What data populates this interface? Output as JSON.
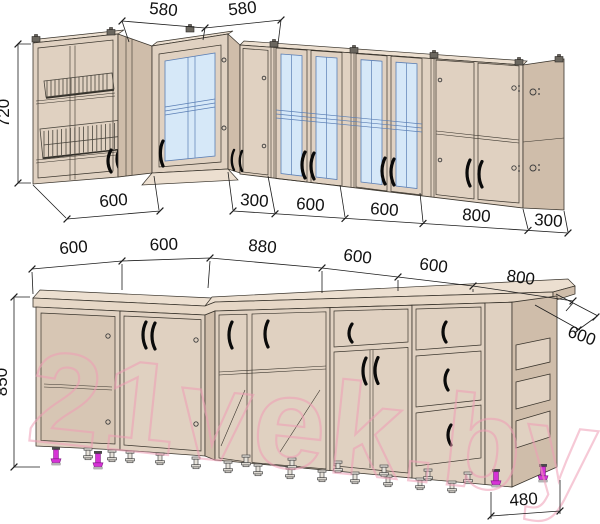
{
  "colors": {
    "face": "#e0d1c1",
    "side": "#cfbdaa",
    "ctop": "#ecdfd0",
    "counter": "#e6d7c6",
    "interior": "#d7c6b4",
    "glass": "#d6e8f8",
    "glassline": "#5b7fb5",
    "outline": "#3a352d",
    "dim": "#1c1c1c",
    "wm": "#ef9db5",
    "magenta": "#d633d6"
  },
  "watermark": {
    "text": "21vek.by"
  },
  "upper": {
    "height": "720",
    "top": [
      "580",
      "580"
    ],
    "bottom": [
      "600",
      "300",
      "600",
      "600",
      "800",
      "300"
    ]
  },
  "lower": {
    "height": "850",
    "top": [
      "600",
      "600",
      "880",
      "600",
      "600",
      "800"
    ],
    "depth": "600",
    "bottom": "480"
  }
}
